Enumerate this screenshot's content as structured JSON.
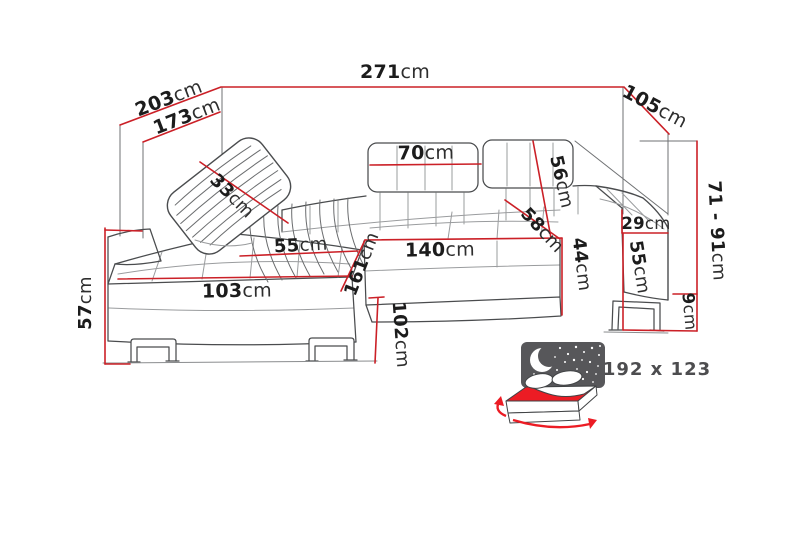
{
  "diagram": {
    "unit": "cm",
    "labels": {
      "total_width": {
        "value": "271",
        "unit": "cm"
      },
      "depth_outer": {
        "value": "203",
        "unit": "cm"
      },
      "depth_inner": {
        "value": "173",
        "unit": "cm"
      },
      "right_side_depth": {
        "value": "105",
        "unit": "cm"
      },
      "back_height_range": {
        "value": "71 - 91",
        "unit": "cm"
      },
      "pillow_width": {
        "value": "33",
        "unit": "cm"
      },
      "headrest_width": {
        "value": "70",
        "unit": "cm"
      },
      "backrest_height": {
        "value": "56",
        "unit": "cm"
      },
      "seat_depth": {
        "value": "58",
        "unit": "cm"
      },
      "armrest_above_seat": {
        "value": "29",
        "unit": "cm"
      },
      "seat_width": {
        "value": "140",
        "unit": "cm"
      },
      "seat_height": {
        "value": "44",
        "unit": "cm"
      },
      "armrest_height": {
        "value": "55",
        "unit": "cm"
      },
      "leg_height": {
        "value": "9",
        "unit": "cm"
      },
      "chaise_seat_width": {
        "value": "55",
        "unit": "cm"
      },
      "chaise_front_width": {
        "value": "103",
        "unit": "cm"
      },
      "chaise_length": {
        "value": "161",
        "unit": "cm"
      },
      "front_corner_height": {
        "value": "57",
        "unit": "cm"
      },
      "chaise_side_height": {
        "value": "102",
        "unit": "cm"
      }
    },
    "sleeping_area": {
      "label": "192 x 123"
    },
    "colors": {
      "dimension_line": "#cb2027",
      "drawing_line": "#4a4c4e",
      "text": "#1c1c1c",
      "bed_accent_red": "#ec1c24",
      "night_panel": "#57575a"
    }
  }
}
